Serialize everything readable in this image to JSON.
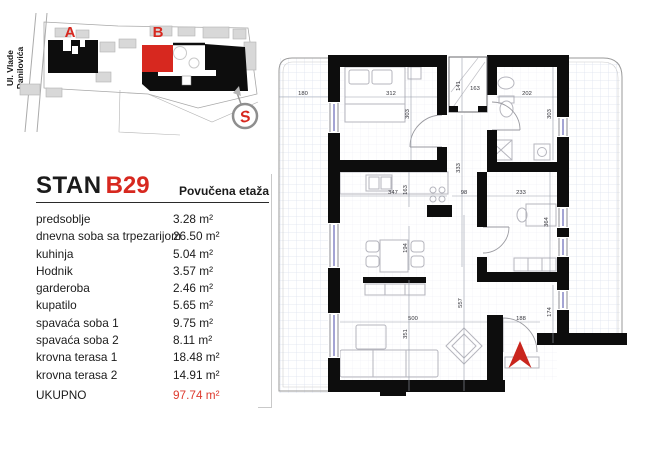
{
  "site_map": {
    "street_label_line1": "Ul. Vlade",
    "street_label_line2": "Danilovića",
    "building_a_label": "A",
    "building_b_label": "B",
    "compass_letter": "S"
  },
  "unit": {
    "title_prefix": "STAN",
    "title_number": "B29",
    "floor_label": "Povučena etaža",
    "rooms": [
      {
        "name": "predsoblje",
        "area": "3.28 m²"
      },
      {
        "name": "dnevna soba sa trpezarijom",
        "area": "26.50 m²"
      },
      {
        "name": "kuhinja",
        "area": "5.04 m²"
      },
      {
        "name": "Hodnik",
        "area": "3.57 m²"
      },
      {
        "name": "garderoba",
        "area": "2.46 m²"
      },
      {
        "name": "kupatilo",
        "area": "5.65 m²"
      },
      {
        "name": "spavaća soba 1",
        "area": "9.75 m²"
      },
      {
        "name": "spavaća soba 2",
        "area": "8.11 m²"
      },
      {
        "name": "krovna terasa 1",
        "area": "18.48 m²"
      },
      {
        "name": "krovna terasa 2",
        "area": "14.91 m²"
      }
    ],
    "total_label": "UKUPNO",
    "total_area": "97.74 m²"
  },
  "floorplan": {
    "dims": {
      "terrace1_width": "180",
      "bedroom1_width": "312",
      "shaft_height": "141",
      "shaft_width": "163",
      "bathroom_width": "202",
      "bedroom1_depth": "303",
      "bathroom_depth": "303",
      "kitchen_width": "347",
      "kitchen_depth": "163",
      "hallway_width": "98",
      "hallway_length": "333",
      "bedroom2_width": "233",
      "bedroom2_depth": "364",
      "dining_depth": "194",
      "living_width": "500",
      "living_part_depth": "351",
      "living_length": "557",
      "entry_door_width": "188",
      "vestibule_depth": "174"
    }
  },
  "colors": {
    "accent_red": "#d7281f",
    "total_red": "#de3a2e",
    "wall_black": "#0d0d0d",
    "terrace_grid": "#dbe1ee"
  }
}
